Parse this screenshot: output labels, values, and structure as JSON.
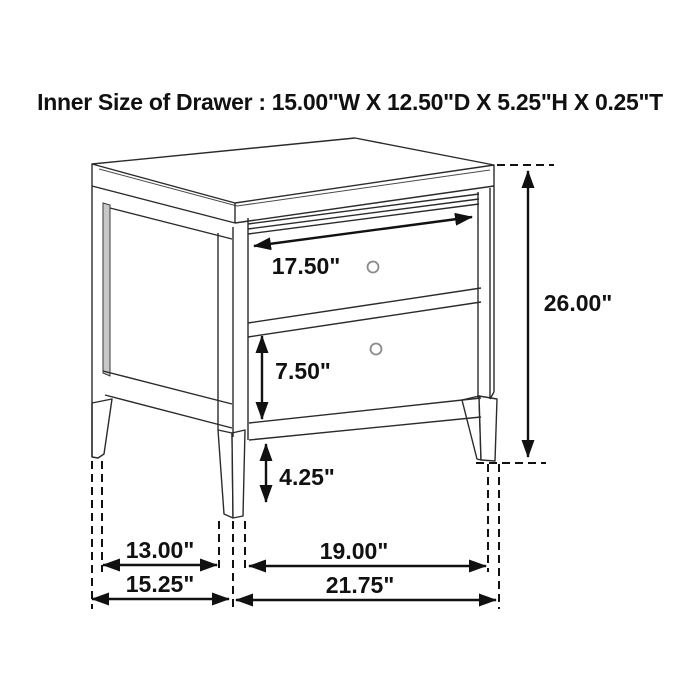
{
  "title": "Inner Size of Drawer : 15.00\"W X 12.50\"D X 5.25\"H X 0.25\"T",
  "dimensions": {
    "top_drawer_width": "17.50\"",
    "bottom_drawer_height": "7.50\"",
    "leg_clearance_height": "4.25\"",
    "overall_height": "26.00\"",
    "side_leg_inner_span": "13.00\"",
    "side_depth": "15.25\"",
    "front_leg_inner_span": "19.00\"",
    "front_width": "21.75\""
  },
  "colors": {
    "line": "#2b2b2b",
    "dimension": "#111111",
    "panel_shade": "#c8c8c8",
    "knob": "#8a8a8a",
    "background": "#ffffff"
  }
}
